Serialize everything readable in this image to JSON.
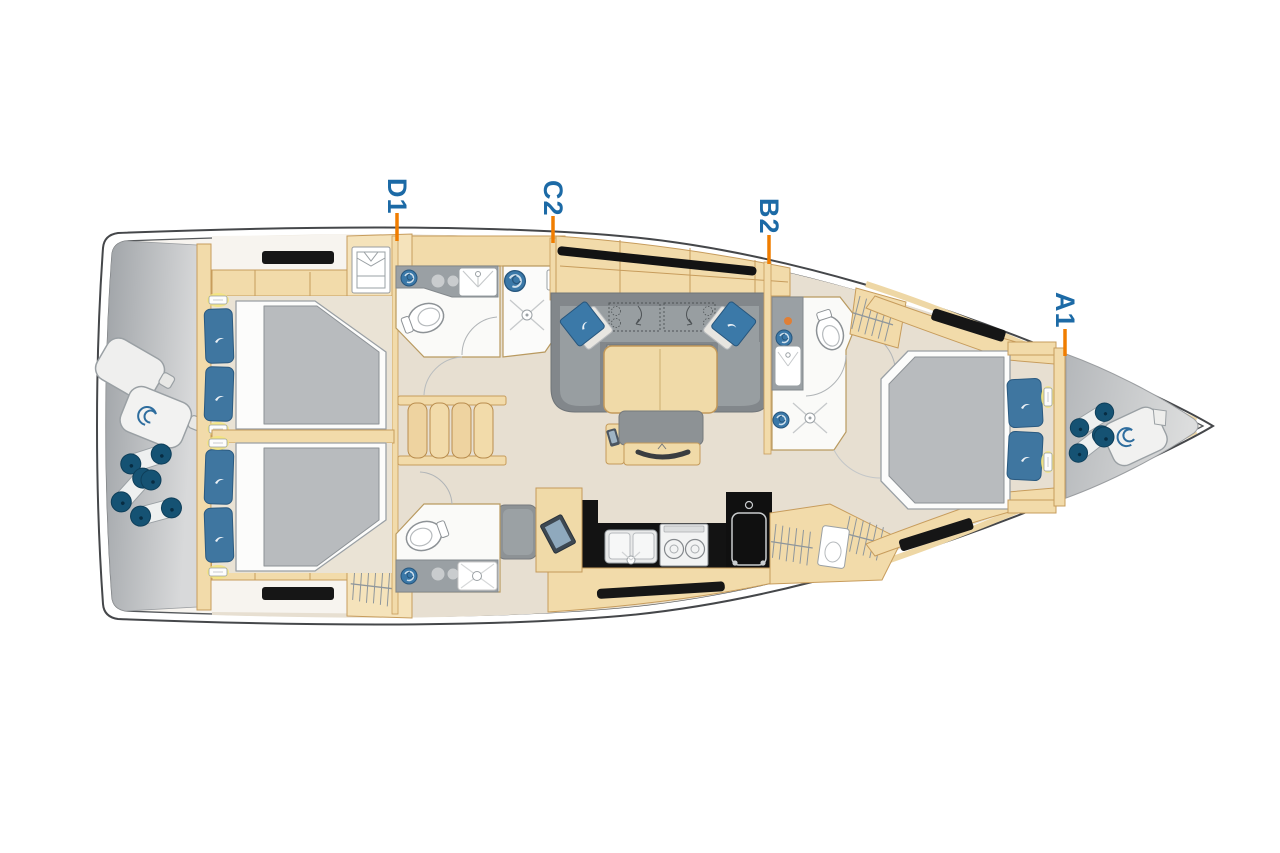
{
  "page": {
    "title": "Sailing yacht interior layout floor plan",
    "orientation": "bow-right"
  },
  "labels": [
    {
      "id": "D1",
      "text": "D1"
    },
    {
      "id": "C2",
      "text": "C2"
    },
    {
      "id": "B2",
      "text": "B2"
    },
    {
      "id": "A1",
      "text": "A1"
    }
  ],
  "colors": {
    "label_blue": "#1c6aa6",
    "leader_orange": "#f07d00",
    "hull_outline": "#45474a",
    "deck_white": "#f7f4ef",
    "floor_beige": "#e7dfd1",
    "wood": "#f2dbaa",
    "wood_border": "#c79c5c",
    "platform_gray_dark": "#a2a6aa",
    "platform_gray_light": "#d8d9da",
    "sofa_gray": "#82878b",
    "sofa_seat_gray": "#989ea1",
    "mattress_gray": "#b8bbbe",
    "pillow_blue": "#3f76a0",
    "cushion_blue": "#3b79a8",
    "counter_black": "#131313",
    "hatch_black": "#161616",
    "bath_counter_gray": "#9aa0a4",
    "fender_navy": "#155273",
    "lamp_yellow": "#f3e57d"
  }
}
